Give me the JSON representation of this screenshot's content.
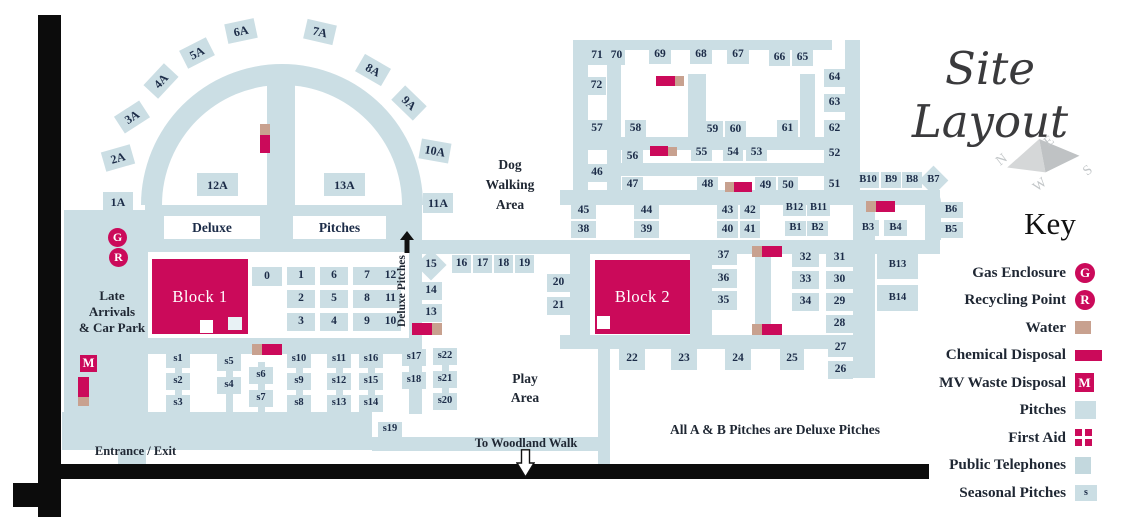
{
  "map_title": "Site Layout",
  "key": {
    "title": "Key",
    "items": [
      {
        "label": "Gas Enclosure",
        "icon": "gas-enclosure",
        "letter": "G"
      },
      {
        "label": "Recycling Point",
        "icon": "recycling-point",
        "letter": "R"
      },
      {
        "label": "Water",
        "icon": "water",
        "letter": ""
      },
      {
        "label": "Chemical Disposal",
        "icon": "chemical-disposal",
        "letter": ""
      },
      {
        "label": "MV Waste Disposal",
        "icon": "mv-waste-disposal",
        "letter": "M"
      },
      {
        "label": "Pitches",
        "icon": "pitch",
        "letter": ""
      },
      {
        "label": "First Aid",
        "icon": "first-aid",
        "letter": ""
      },
      {
        "label": "Public Telephones",
        "icon": "public-telephone",
        "letter": ""
      },
      {
        "label": "Seasonal Pitches",
        "icon": "seasonal-pitch",
        "letter": "s"
      }
    ]
  },
  "compass": {
    "n": "N",
    "e": "E",
    "s": "S",
    "w": "W"
  },
  "labels": {
    "deluxe": "Deluxe",
    "pitches": "Pitches",
    "dog_walking": [
      "Dog",
      "Walking",
      "Area"
    ],
    "play_area": [
      "Play",
      "Area"
    ],
    "late_arrivals": [
      "Late",
      "Arrivals",
      "& Car Park"
    ],
    "entrance": "Entrance / Exit",
    "woodland": "To Woodland Walk",
    "note": "All A & B Pitches are Deluxe Pitches",
    "deluxe_pitches_road": "Deluxe Pitches",
    "block1": "Block 1",
    "block2": "Block 2",
    "gas": "G",
    "recycling": "R",
    "mv": "M"
  },
  "colors": {
    "pitch_blue": "#cbdee4",
    "accent_magenta": "#cb0a5a",
    "water_tan": "#c8a18f",
    "text_navy": "#1c2c48"
  },
  "map": {
    "pitch_format": [
      "id",
      "x",
      "y",
      "w",
      "h",
      "rotation_deg"
    ],
    "pitches": [
      [
        "1A",
        103,
        192,
        30,
        20,
        0
      ],
      [
        "2A",
        103,
        148,
        30,
        20,
        -16
      ],
      [
        "3A",
        117,
        107,
        30,
        20,
        -33
      ],
      [
        "4A",
        146,
        71,
        30,
        20,
        -47
      ],
      [
        "5A",
        182,
        43,
        30,
        20,
        -27
      ],
      [
        "6A",
        226,
        21,
        30,
        20,
        -12
      ],
      [
        "7A",
        305,
        22,
        30,
        20,
        13
      ],
      [
        "8A",
        358,
        60,
        30,
        20,
        30
      ],
      [
        "9A",
        394,
        93,
        30,
        20,
        44
      ],
      [
        "10A",
        420,
        141,
        30,
        20,
        10
      ],
      [
        "11A",
        423,
        193,
        30,
        20,
        0
      ],
      [
        "12A",
        197,
        173,
        41,
        23,
        0
      ],
      [
        "13A",
        324,
        173,
        41,
        23,
        0
      ],
      [
        "0",
        252,
        267,
        30,
        19,
        0
      ],
      [
        "1",
        287,
        267,
        28,
        18,
        0
      ],
      [
        "6",
        320,
        267,
        28,
        18,
        0
      ],
      [
        "7",
        353,
        267,
        28,
        18,
        0
      ],
      [
        "12",
        380,
        267,
        21,
        18,
        0
      ],
      [
        "2",
        287,
        290,
        28,
        18,
        0
      ],
      [
        "5",
        320,
        290,
        28,
        18,
        0
      ],
      [
        "8",
        353,
        290,
        28,
        18,
        0
      ],
      [
        "11",
        380,
        290,
        21,
        18,
        0
      ],
      [
        "3",
        287,
        313,
        28,
        18,
        0
      ],
      [
        "4",
        320,
        313,
        28,
        18,
        0
      ],
      [
        "9",
        353,
        313,
        28,
        18,
        0
      ],
      [
        "10",
        380,
        313,
        21,
        18,
        0
      ],
      [
        "15",
        420,
        254,
        22,
        22,
        45
      ],
      [
        "16",
        452,
        255,
        19,
        18,
        0
      ],
      [
        "17",
        473,
        255,
        19,
        18,
        0
      ],
      [
        "18",
        494,
        255,
        19,
        18,
        0
      ],
      [
        "19",
        515,
        255,
        19,
        18,
        0
      ],
      [
        "14",
        420,
        282,
        22,
        18,
        0
      ],
      [
        "13",
        420,
        304,
        22,
        18,
        0
      ],
      [
        "20",
        547,
        274,
        23,
        18,
        0
      ],
      [
        "21",
        547,
        297,
        23,
        18,
        0
      ],
      [
        "22",
        619,
        348,
        26,
        22,
        0
      ],
      [
        "23",
        671,
        348,
        26,
        22,
        0
      ],
      [
        "24",
        725,
        348,
        26,
        22,
        0
      ],
      [
        "25",
        780,
        348,
        24,
        22,
        0
      ],
      [
        "37",
        710,
        246,
        27,
        19,
        0
      ],
      [
        "36",
        710,
        269,
        27,
        19,
        0
      ],
      [
        "35",
        710,
        291,
        27,
        19,
        0
      ],
      [
        "32",
        792,
        249,
        27,
        18,
        0
      ],
      [
        "33",
        792,
        271,
        27,
        18,
        0
      ],
      [
        "34",
        792,
        293,
        27,
        18,
        0
      ],
      [
        "31",
        826,
        249,
        27,
        18,
        0
      ],
      [
        "30",
        826,
        271,
        27,
        18,
        0
      ],
      [
        "29",
        826,
        293,
        27,
        18,
        0
      ],
      [
        "28",
        826,
        315,
        27,
        18,
        0
      ],
      [
        "27",
        828,
        339,
        25,
        18,
        0
      ],
      [
        "26",
        828,
        361,
        25,
        18,
        0
      ],
      [
        "45",
        571,
        202,
        25,
        17,
        0
      ],
      [
        "44",
        634,
        202,
        25,
        17,
        0
      ],
      [
        "43",
        717,
        202,
        21,
        17,
        0
      ],
      [
        "42",
        740,
        202,
        20,
        17,
        0
      ],
      [
        "38",
        571,
        221,
        25,
        17,
        0
      ],
      [
        "39",
        634,
        221,
        25,
        17,
        0
      ],
      [
        "40",
        717,
        221,
        21,
        17,
        0
      ],
      [
        "41",
        740,
        221,
        20,
        17,
        0
      ],
      [
        "46",
        587,
        164,
        20,
        18,
        0
      ],
      [
        "47",
        622,
        177,
        21,
        16,
        0
      ],
      [
        "48",
        697,
        177,
        21,
        16,
        0
      ],
      [
        "49",
        755,
        177,
        21,
        17,
        0
      ],
      [
        "50",
        778,
        177,
        20,
        17,
        0
      ],
      [
        "51",
        824,
        176,
        21,
        17,
        0
      ],
      [
        "56",
        622,
        148,
        21,
        17,
        0
      ],
      [
        "55",
        691,
        144,
        21,
        17,
        0
      ],
      [
        "54",
        723,
        144,
        20,
        17,
        0
      ],
      [
        "53",
        746,
        144,
        21,
        17,
        0
      ],
      [
        "52",
        824,
        145,
        21,
        18,
        0
      ],
      [
        "57",
        587,
        120,
        20,
        18,
        0
      ],
      [
        "58",
        625,
        120,
        21,
        18,
        0
      ],
      [
        "59",
        702,
        121,
        21,
        17,
        0
      ],
      [
        "60",
        725,
        121,
        21,
        17,
        0
      ],
      [
        "61",
        777,
        120,
        21,
        18,
        0
      ],
      [
        "62",
        824,
        120,
        21,
        18,
        0
      ],
      [
        "63",
        824,
        94,
        21,
        18,
        0
      ],
      [
        "64",
        824,
        69,
        21,
        18,
        0
      ],
      [
        "72",
        587,
        77,
        19,
        18,
        0
      ],
      [
        "71",
        587,
        47,
        20,
        18,
        0
      ],
      [
        "70",
        608,
        47,
        17,
        18,
        0
      ],
      [
        "69",
        649,
        46,
        22,
        18,
        0
      ],
      [
        "68",
        690,
        46,
        22,
        18,
        0
      ],
      [
        "67",
        727,
        46,
        22,
        18,
        0
      ],
      [
        "66",
        769,
        50,
        21,
        16,
        0
      ],
      [
        "65",
        792,
        50,
        21,
        16,
        0
      ],
      [
        "B12",
        783,
        201,
        23,
        15,
        0
      ],
      [
        "B11",
        807,
        201,
        23,
        15,
        0
      ],
      [
        "B1",
        785,
        221,
        21,
        15,
        0
      ],
      [
        "B2",
        807,
        221,
        21,
        15,
        0
      ],
      [
        "B10",
        857,
        172,
        22,
        16,
        0
      ],
      [
        "B9",
        881,
        172,
        20,
        16,
        0
      ],
      [
        "B8",
        902,
        172,
        20,
        16,
        0
      ],
      [
        "B7",
        923,
        170,
        21,
        21,
        45
      ],
      [
        "B6",
        939,
        202,
        24,
        16,
        0
      ],
      [
        "B5",
        939,
        222,
        24,
        16,
        0
      ],
      [
        "B3",
        857,
        220,
        22,
        16,
        0
      ],
      [
        "B4",
        884,
        220,
        23,
        16,
        0
      ],
      [
        "B13",
        877,
        252,
        41,
        27,
        0
      ],
      [
        "B14",
        877,
        285,
        41,
        26,
        0
      ],
      [
        "s1",
        166,
        351,
        24,
        17,
        0
      ],
      [
        "s2",
        166,
        373,
        24,
        17,
        0
      ],
      [
        "s3",
        166,
        395,
        24,
        17,
        0
      ],
      [
        "s5",
        217,
        354,
        24,
        17,
        0
      ],
      [
        "s4",
        217,
        377,
        24,
        17,
        0
      ],
      [
        "s6",
        249,
        367,
        24,
        17,
        0
      ],
      [
        "s7",
        249,
        390,
        24,
        17,
        0
      ],
      [
        "s10",
        287,
        351,
        24,
        17,
        0
      ],
      [
        "s9",
        287,
        373,
        24,
        17,
        0
      ],
      [
        "s8",
        287,
        395,
        24,
        17,
        0
      ],
      [
        "s11",
        327,
        351,
        24,
        17,
        0
      ],
      [
        "s12",
        327,
        373,
        24,
        17,
        0
      ],
      [
        "s13",
        327,
        395,
        24,
        17,
        0
      ],
      [
        "s16",
        359,
        351,
        24,
        17,
        0
      ],
      [
        "s15",
        359,
        373,
        24,
        17,
        0
      ],
      [
        "s14",
        359,
        395,
        24,
        17,
        0
      ],
      [
        "s17",
        402,
        349,
        24,
        17,
        0
      ],
      [
        "s18",
        402,
        372,
        24,
        17,
        0
      ],
      [
        "s22",
        433,
        348,
        24,
        17,
        0
      ],
      [
        "s21",
        433,
        371,
        24,
        17,
        0
      ],
      [
        "s20",
        433,
        393,
        24,
        17,
        0
      ],
      [
        "s19",
        378,
        422,
        24,
        15,
        0
      ]
    ]
  }
}
